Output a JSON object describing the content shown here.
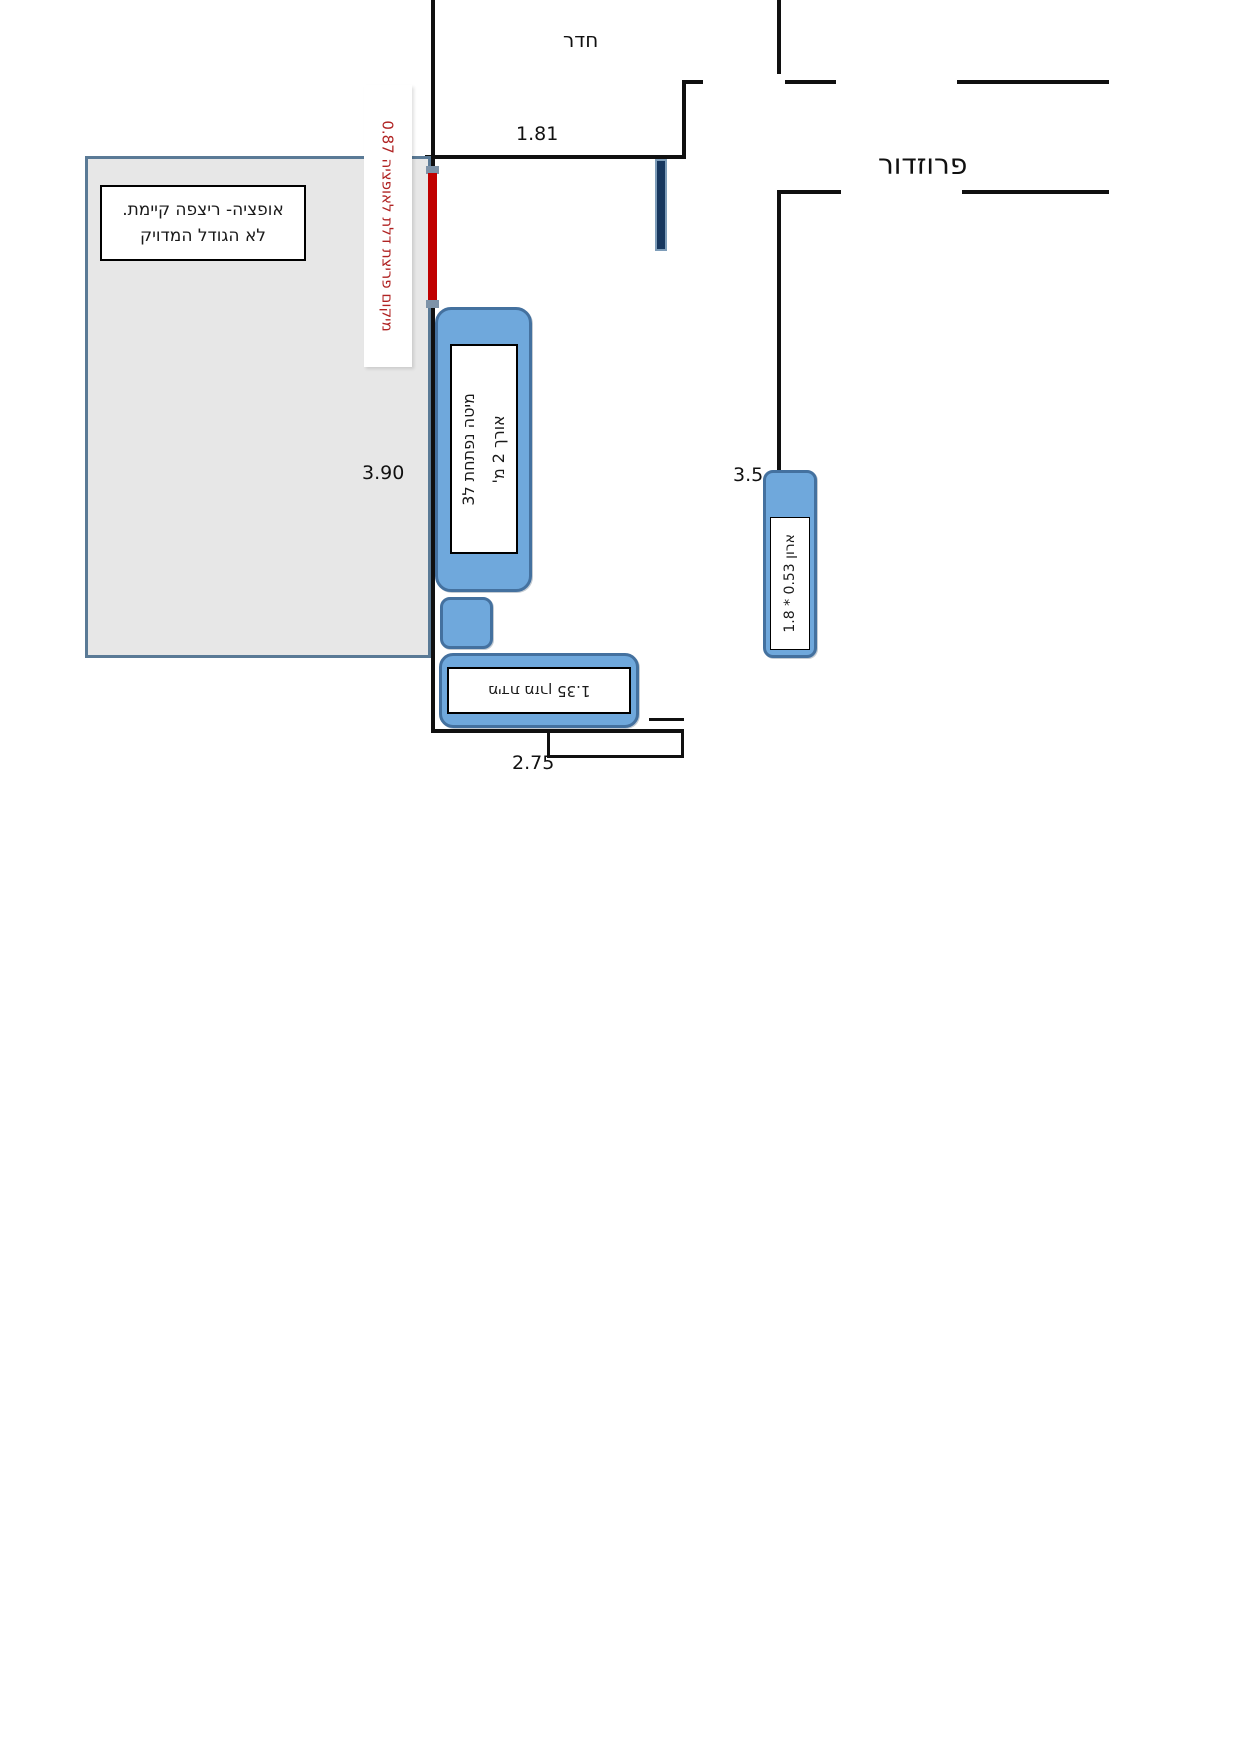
{
  "rooms": {
    "top_room_label": "חדר",
    "corridor_label": "פרוזדור"
  },
  "dimensions": {
    "room_opening": "1.81",
    "left_wall": "3.90",
    "right_wall": "3.5",
    "bottom_wall": "2.75"
  },
  "option_area": {
    "note_line1": "אופציה- ריצפה קיימת.",
    "note_line2": "לא הגודל המדויק"
  },
  "door_breach_note": "מיקום פריצת דלת לאופציה 0.87",
  "furniture": {
    "bed": {
      "line1": "מיטה נפתחת ל3",
      "line2": "אורך 2 מ'"
    },
    "mattress_bar": {
      "label": "מידת מזרן 1.35"
    },
    "closet": {
      "label": "ארון 0.53 * 1.8"
    }
  },
  "colors": {
    "furniture_fill": "#6fa8dc",
    "furniture_border": "#44719f",
    "option_fill": "#e7e7e7",
    "option_border": "#5a7a96",
    "breach_marker": "#c00000",
    "breach_note_text": "#b02323",
    "door_leaf_fill": "#17375e",
    "door_leaf_border": "#7e9db9",
    "wall": "#101010"
  }
}
